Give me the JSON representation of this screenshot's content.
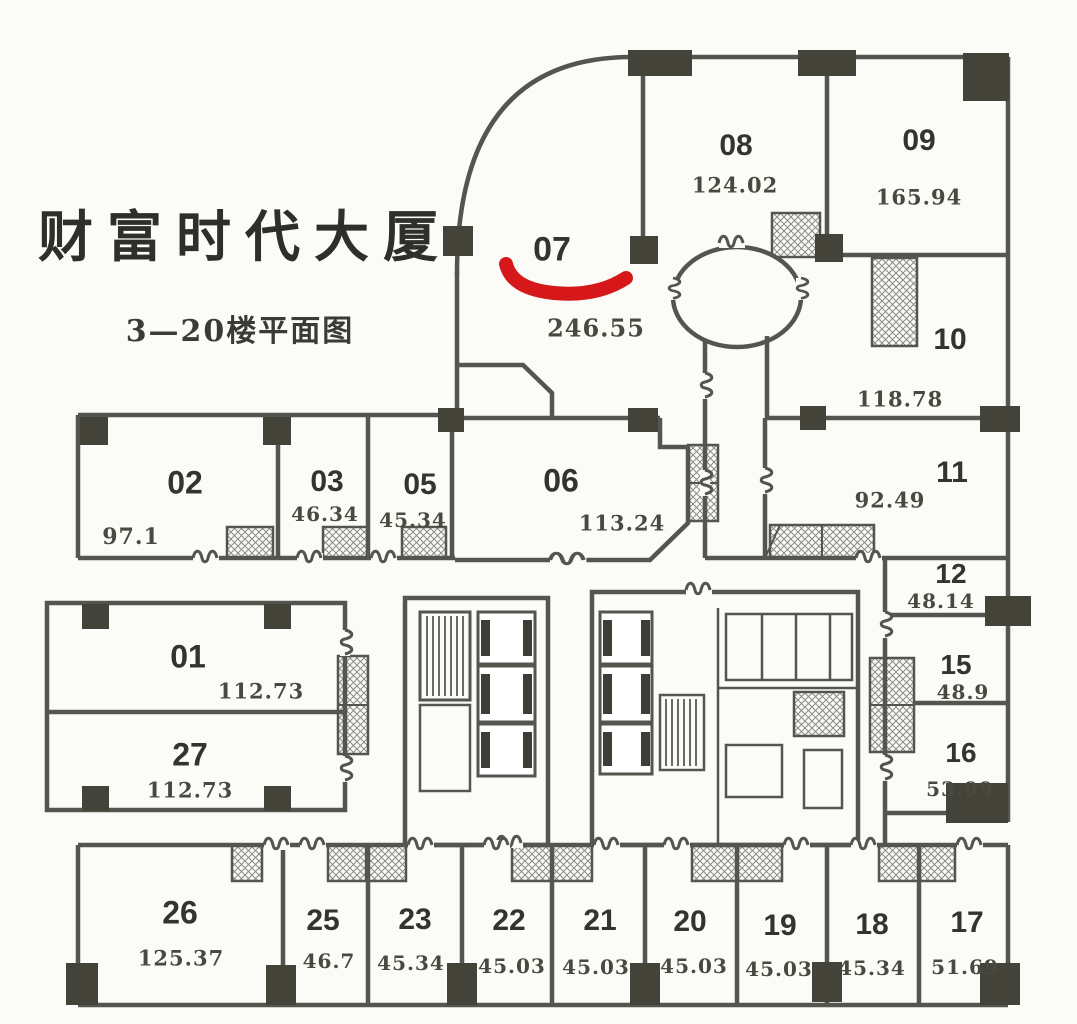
{
  "title": "财富时代大厦",
  "subtitle": "3—20楼平面图",
  "highlight": {
    "target_room": "07",
    "style": "red-brush-underline",
    "color": "#d7181a"
  },
  "colors": {
    "background": "#fbfbf8",
    "wall": "#55544e",
    "column": "#44433a",
    "text": "#34342f",
    "highlight": "#d7181a"
  },
  "rooms": [
    {
      "number": "07",
      "area": "246.55"
    },
    {
      "number": "08",
      "area": "124.02"
    },
    {
      "number": "09",
      "area": "165.94"
    },
    {
      "number": "10",
      "area": "118.78"
    },
    {
      "number": "11",
      "area": "92.49"
    },
    {
      "number": "12",
      "area": "48.14"
    },
    {
      "number": "15",
      "area": "48.9"
    },
    {
      "number": "16",
      "area": "53.99"
    },
    {
      "number": "02",
      "area": "97.1"
    },
    {
      "number": "03",
      "area": "46.34"
    },
    {
      "number": "05",
      "area": "45.34"
    },
    {
      "number": "06",
      "area": "113.24"
    },
    {
      "number": "01",
      "area": "112.73"
    },
    {
      "number": "27",
      "area": "112.73"
    },
    {
      "number": "26",
      "area": "125.37"
    },
    {
      "number": "25",
      "area": "46.7"
    },
    {
      "number": "23",
      "area": "45.34"
    },
    {
      "number": "22",
      "area": "45.03"
    },
    {
      "number": "21",
      "area": "45.03"
    },
    {
      "number": "20",
      "area": "45.03"
    },
    {
      "number": "19",
      "area": "45.03"
    },
    {
      "number": "18",
      "area": "45.34"
    },
    {
      "number": "17",
      "area": "51.69"
    }
  ]
}
